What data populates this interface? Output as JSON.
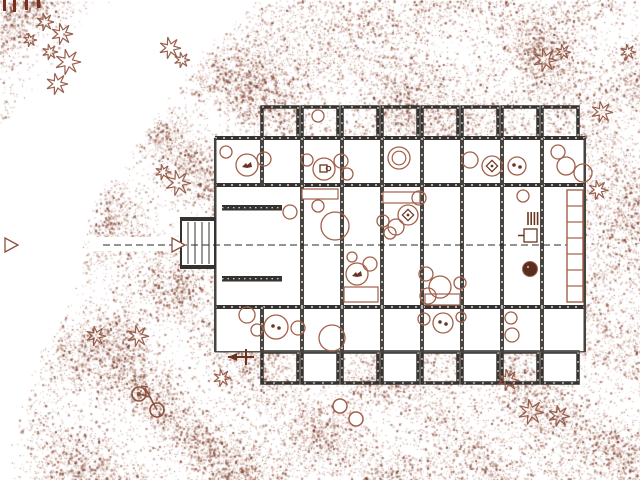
{
  "meta": {
    "title": "Architectural site plan — ground floor with terraces",
    "visible_text": []
  },
  "palette": {
    "background": "#ffffff",
    "stipple_tones": [
      "#8a4736",
      "#a05a44",
      "#b97f69",
      "#7c3a2a",
      "#c79d8a"
    ],
    "stipple_dark": "#6e3424",
    "wall_dark": "#35322f",
    "wall_gray": "#47433f",
    "outline_thin": "#555550",
    "vegetation": "#8e4f3c",
    "furniture": "#a2604a",
    "glyph_dark": "#6b3421",
    "fence": "#7a2e1f",
    "section_line": "#2a2a2a",
    "pot_fill": "#5a2d1e",
    "white": "#ffffff"
  },
  "canvas": {
    "width": 640,
    "height": 480,
    "seed": 20240731
  },
  "stipple": {
    "boundary": [
      [
        265,
        0
      ],
      [
        205,
        60
      ],
      [
        143,
        150
      ],
      [
        105,
        200
      ],
      [
        95,
        250
      ],
      [
        70,
        320
      ],
      [
        57,
        330
      ],
      [
        15,
        480
      ]
    ],
    "corner_triangle": {
      "w": 112,
      "h": 132
    },
    "attempts": 95000,
    "dark_attempts": 11000
  },
  "building": {
    "body": {
      "x": 215,
      "y": 138,
      "w": 370,
      "h": 214
    },
    "h_walls": [
      {
        "x": 215,
        "y": 136,
        "w": 370,
        "h": 4
      },
      {
        "x": 215,
        "y": 183,
        "w": 370,
        "h": 4
      },
      {
        "x": 215,
        "y": 305,
        "w": 370,
        "h": 4
      }
    ],
    "facade_line": {
      "x": 215,
      "y": 351,
      "w": 370,
      "h": 1.5
    },
    "side_walls": [
      {
        "x": 214,
        "y": 138,
        "w": 2.5,
        "h": 214
      },
      {
        "x": 583.5,
        "y": 138,
        "w": 2.5,
        "h": 214
      }
    ],
    "v_walls_upper": {
      "xs": [
        262,
        302,
        342,
        382,
        422,
        462,
        502,
        542
      ],
      "y1": 138,
      "y2": 186
    },
    "v_walls_mid": {
      "xs": [
        302,
        342,
        382,
        422,
        462,
        502,
        542
      ],
      "y1": 185,
      "y2": 307
    },
    "v_walls_lower": {
      "xs": [
        262,
        302,
        342,
        382,
        422,
        462,
        502,
        542
      ],
      "y1": 307,
      "y2": 352
    },
    "top_bays": {
      "xs": [
        262,
        302,
        342,
        382,
        422,
        462,
        502,
        542
      ],
      "y": 107,
      "w": 36,
      "h": 31
    },
    "bottom_bays": {
      "xs": [
        262,
        302,
        342,
        382,
        422,
        462,
        502,
        542
      ],
      "y": 352,
      "w": 36,
      "h": 31,
      "white_every_other": true
    },
    "benches": [
      {
        "x": 222,
        "y": 205,
        "w": 60,
        "h": 5.5
      },
      {
        "x": 222,
        "y": 276,
        "w": 60,
        "h": 5.5
      }
    ],
    "dock": {
      "x": 181,
      "y": 218,
      "w": 34,
      "h": 50,
      "plank_xs": [
        188,
        195,
        202,
        209
      ]
    },
    "section": {
      "y": 245,
      "x1": 103,
      "x2": 584,
      "white_band": {
        "x": 90,
        "y": 237,
        "w": 126,
        "h": 14
      },
      "arrows": [
        {
          "x": 5
        },
        {
          "x": 172
        }
      ]
    },
    "ladder": {
      "x": 567,
      "y": 190,
      "w": 16,
      "h": 112,
      "rungs": 6
    },
    "kitchen": {
      "stove_bars": {
        "x": 528,
        "y": 212,
        "n": 4,
        "step": 3.2,
        "h": 13
      },
      "sink": {
        "x": 524,
        "y": 229,
        "w": 13,
        "h": 13
      },
      "pot": {
        "cx": 530,
        "cy": 269,
        "r": 7.5
      }
    },
    "marker_arrow": {
      "x": 228,
      "y": 357
    }
  },
  "furniture": {
    "circles": [
      [
        226,
        152,
        6,
        ""
      ],
      [
        247,
        165,
        11,
        "bird"
      ],
      [
        264,
        159,
        7,
        ""
      ],
      [
        307,
        160,
        6,
        ""
      ],
      [
        324,
        169,
        11,
        "cup"
      ],
      [
        341,
        161,
        7,
        ""
      ],
      [
        347,
        174,
        6,
        ""
      ],
      [
        399,
        158,
        11,
        "double"
      ],
      [
        470,
        160,
        8,
        ""
      ],
      [
        492,
        166,
        10,
        "table"
      ],
      [
        517,
        166,
        9,
        "dots"
      ],
      [
        558,
        152,
        7,
        ""
      ],
      [
        566,
        166,
        9,
        ""
      ],
      [
        583,
        173,
        9,
        ""
      ],
      [
        318,
        116,
        6,
        "white"
      ],
      [
        290,
        212,
        7,
        ""
      ],
      [
        318,
        206,
        6,
        ""
      ],
      [
        335,
        226,
        14,
        ""
      ],
      [
        396,
        227,
        8,
        ""
      ],
      [
        383,
        221,
        6,
        ""
      ],
      [
        408,
        215,
        10,
        "table"
      ],
      [
        419,
        198,
        7,
        ""
      ],
      [
        390,
        233,
        6,
        ""
      ],
      [
        352,
        257,
        5,
        ""
      ],
      [
        370,
        264,
        7,
        ""
      ],
      [
        357,
        274,
        11,
        "bird"
      ],
      [
        426,
        274,
        7,
        ""
      ],
      [
        440,
        287,
        11,
        ""
      ],
      [
        460,
        283,
        6,
        ""
      ],
      [
        428,
        296,
        8,
        ""
      ],
      [
        523,
        196,
        6,
        ""
      ],
      [
        247,
        315,
        8,
        ""
      ],
      [
        257,
        330,
        6,
        ""
      ],
      [
        276,
        327,
        12,
        "dots"
      ],
      [
        298,
        328,
        7,
        ""
      ],
      [
        332,
        338,
        13,
        ""
      ],
      [
        424,
        319,
        6,
        ""
      ],
      [
        443,
        323,
        10,
        "dots"
      ],
      [
        461,
        317,
        5,
        ""
      ],
      [
        511,
        318,
        6,
        ""
      ],
      [
        512,
        335,
        7,
        ""
      ]
    ],
    "rects": [
      [
        302,
        189,
        36,
        10
      ],
      [
        383,
        192,
        37,
        11
      ],
      [
        344,
        287,
        34,
        15
      ],
      [
        425,
        294,
        35,
        11
      ]
    ]
  },
  "site": {
    "trees": [
      [
        45,
        22,
        9
      ],
      [
        62,
        34,
        11
      ],
      [
        50,
        52,
        8
      ],
      [
        68,
        62,
        13
      ],
      [
        57,
        84,
        11
      ],
      [
        30,
        40,
        7
      ],
      [
        170,
        48,
        11
      ],
      [
        182,
        60,
        8
      ],
      [
        163,
        172,
        8
      ],
      [
        178,
        183,
        13
      ],
      [
        96,
        336,
        10
      ],
      [
        138,
        336,
        11
      ],
      [
        222,
        378,
        9
      ],
      [
        545,
        60,
        12
      ],
      [
        563,
        52,
        8
      ],
      [
        628,
        52,
        8
      ],
      [
        602,
        112,
        11
      ],
      [
        598,
        190,
        10
      ],
      [
        508,
        380,
        11
      ],
      [
        531,
        412,
        13
      ],
      [
        559,
        416,
        11
      ]
    ],
    "bushes": [
      [
        340,
        406,
        7
      ],
      [
        356,
        419,
        7
      ]
    ],
    "bicycle": {
      "wheel1": [
        139,
        394,
        7
      ],
      "wheel2": [
        157,
        410,
        7
      ]
    },
    "fence_posts": [
      [
        3,
        0,
        3,
        11
      ],
      [
        13,
        0,
        3,
        12
      ],
      [
        25,
        0,
        3,
        10
      ],
      [
        37,
        0,
        3,
        8
      ]
    ]
  }
}
